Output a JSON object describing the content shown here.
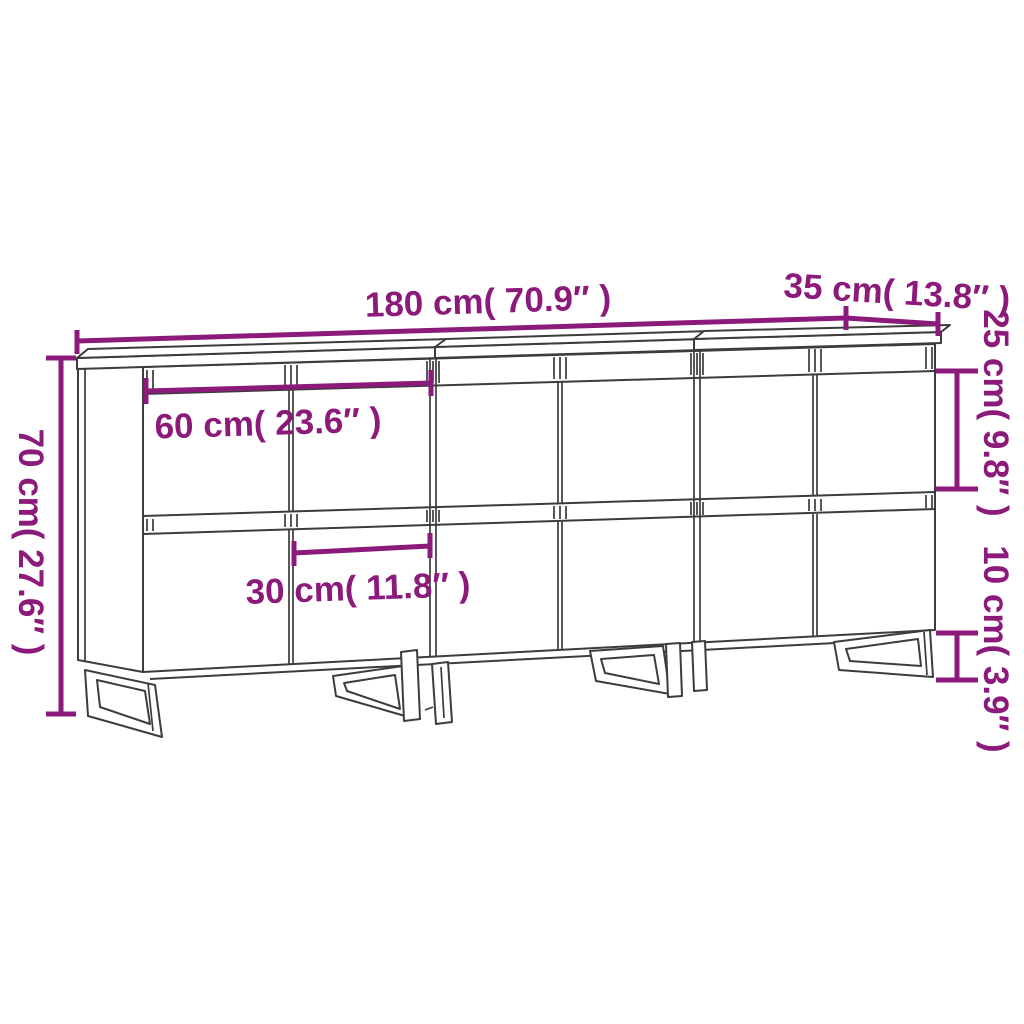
{
  "diagram": {
    "kind": "furniture-dimension-diagram",
    "product": "3-piece sideboard with doors and metal legs",
    "background_color": "#ffffff",
    "outline_color": "#3C3C3C",
    "dimension_color": "#8B1A7B",
    "labels": {
      "overall_width": "180 cm( 70.9″ )",
      "overall_depth": "35 cm( 13.8″ )",
      "overall_height": "70 cm( 27.6″ )",
      "compartment_height": "25 cm( 9.8″ )",
      "leg_height": "10 cm( 3.9″ )",
      "section_width": "60 cm( 23.6″ )",
      "door_width": "30 cm( 11.8″ )"
    },
    "values": {
      "overall_width_cm": 180,
      "overall_width_in": 70.9,
      "overall_depth_cm": 35,
      "overall_depth_in": 13.8,
      "overall_height_cm": 70,
      "overall_height_in": 27.6,
      "compartment_height_cm": 25,
      "compartment_height_in": 9.8,
      "leg_height_cm": 10,
      "leg_height_in": 3.9,
      "section_width_cm": 60,
      "section_width_in": 23.6,
      "door_width_cm": 30,
      "door_width_in": 11.8
    }
  }
}
